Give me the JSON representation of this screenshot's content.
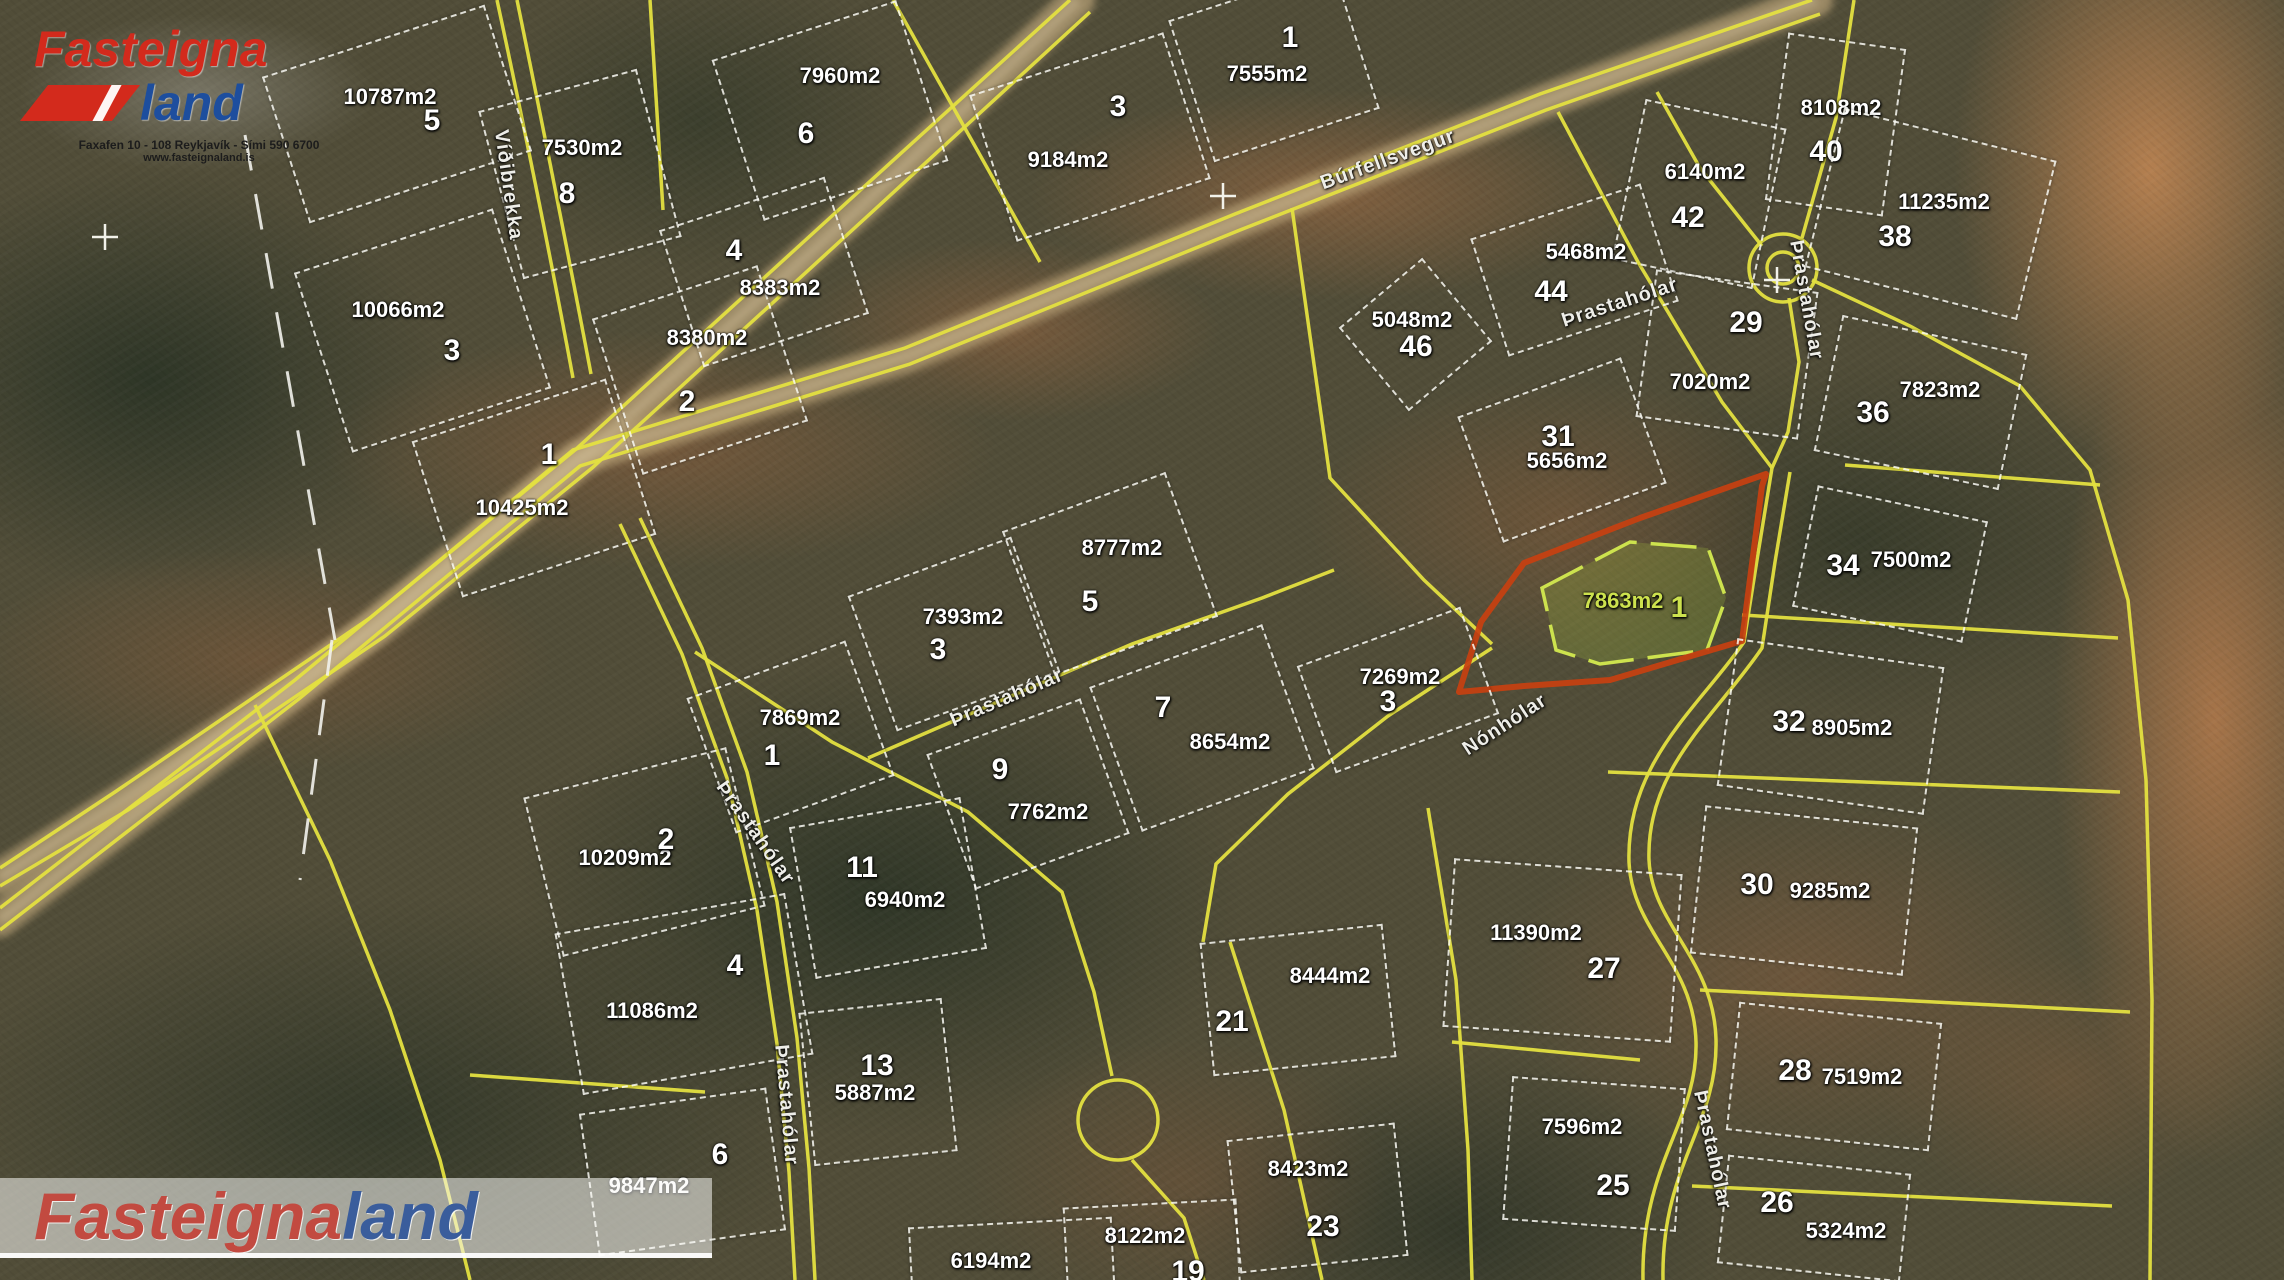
{
  "watermark_top": {
    "brand_red": "Fasteigna",
    "brand_blue": "land",
    "address_line": "Faxafen 10 - 108 Reykjavík - Sími 590 6700",
    "website": "www.fasteignaland.is"
  },
  "watermark_bottom": {
    "brand_red": "Fasteigna",
    "brand_blue": "land"
  },
  "colors": {
    "boundary_yellow": "#e4e040",
    "parcel_white": "#f2f2ec",
    "highlight_red": "#c84010",
    "highlight_green": "#cde24e",
    "gravel": "#b7a076",
    "label_white": "#ffffff"
  },
  "highlighted_lot": {
    "number": "1",
    "area": "7863m2"
  },
  "parcels": [
    {
      "num": "5",
      "nx": 432,
      "ny": 121,
      "area": "10787m2",
      "ax": 390,
      "ay": 97,
      "box": [
        395,
        112,
        230,
        150,
        -18
      ]
    },
    {
      "num": "8",
      "nx": 567,
      "ny": 194,
      "area": "7530m2",
      "ax": 582,
      "ay": 148,
      "box": [
        578,
        172,
        160,
        170,
        -15
      ]
    },
    {
      "num": "6",
      "nx": 806,
      "ny": 134,
      "area": "7960m2",
      "ax": 840,
      "ay": 76,
      "box": [
        828,
        108,
        190,
        165,
        -18
      ]
    },
    {
      "num": "3",
      "nx": 1118,
      "ny": 107,
      "area": "9184m2",
      "ax": 1068,
      "ay": 160,
      "box": [
        1088,
        135,
        200,
        150,
        -18
      ]
    },
    {
      "num": "1",
      "nx": 1290,
      "ny": 38,
      "area": "7555m2",
      "ax": 1267,
      "ay": 74,
      "box": [
        1272,
        62,
        170,
        145,
        -18
      ]
    },
    {
      "num": "40",
      "nx": 1826,
      "ny": 152,
      "area": "8108m2",
      "ax": 1841,
      "ay": 108,
      "box": [
        1833,
        122,
        115,
        165,
        8
      ]
    },
    {
      "num": "42",
      "nx": 1688,
      "ny": 218,
      "area": "6140m2",
      "ax": 1705,
      "ay": 172,
      "box": [
        1697,
        192,
        140,
        160,
        12
      ]
    },
    {
      "num": "44",
      "nx": 1551,
      "ny": 292,
      "area": "5468m2",
      "ax": 1586,
      "ay": 252,
      "box": [
        1572,
        268,
        175,
        120,
        -18
      ]
    },
    {
      "num": "46",
      "nx": 1416,
      "ny": 347,
      "area": "5048m2",
      "ax": 1412,
      "ay": 320,
      "box": [
        1413,
        332,
        105,
        105,
        -40
      ]
    },
    {
      "num": "38",
      "nx": 1895,
      "ny": 237,
      "area": "11235m2",
      "ax": 1944,
      "ay": 202,
      "box": [
        1928,
        212,
        215,
        160,
        14
      ]
    },
    {
      "num": "29",
      "nx": 1746,
      "ny": 323,
      "area": "7020m2",
      "ax": 1710,
      "ay": 382,
      "box": [
        1725,
        352,
        160,
        145,
        8
      ]
    },
    {
      "num": "36",
      "nx": 1873,
      "ny": 413,
      "area": "7823m2",
      "ax": 1940,
      "ay": 390,
      "box": [
        1918,
        400,
        185,
        135,
        12
      ]
    },
    {
      "num": "31",
      "nx": 1558,
      "ny": 437,
      "area": "5656m2",
      "ax": 1567,
      "ay": 461,
      "box": [
        1560,
        448,
        170,
        130,
        -20
      ]
    },
    {
      "num": "34",
      "nx": 1843,
      "ny": 566,
      "area": "7500m2",
      "ax": 1911,
      "ay": 560,
      "box": [
        1888,
        562,
        170,
        120,
        12
      ]
    },
    {
      "num": "32",
      "nx": 1789,
      "ny": 722,
      "area": "8905m2",
      "ax": 1852,
      "ay": 728,
      "box": [
        1828,
        724,
        205,
        145,
        8
      ]
    },
    {
      "num": "30",
      "nx": 1757,
      "ny": 885,
      "area": "9285m2",
      "ax": 1830,
      "ay": 891,
      "box": [
        1802,
        888,
        210,
        145,
        6
      ]
    },
    {
      "num": "27",
      "nx": 1604,
      "ny": 969,
      "area": "11390m2",
      "ax": 1536,
      "ay": 933,
      "box": [
        1560,
        948,
        225,
        165,
        4
      ]
    },
    {
      "num": "28",
      "nx": 1795,
      "ny": 1071,
      "area": "7519m2",
      "ax": 1862,
      "ay": 1077,
      "box": [
        1832,
        1074,
        200,
        125,
        6
      ]
    },
    {
      "num": "25",
      "nx": 1613,
      "ny": 1186,
      "area": "7596m2",
      "ax": 1582,
      "ay": 1127,
      "box": [
        1592,
        1152,
        170,
        140,
        4
      ]
    },
    {
      "num": "26",
      "nx": 1777,
      "ny": 1203,
      "area": "5324m2",
      "ax": 1846,
      "ay": 1231,
      "box": [
        1812,
        1216,
        180,
        105,
        6
      ]
    },
    {
      "num": "3",
      "nx": 452,
      "ny": 351,
      "area": "10066m2",
      "ax": 398,
      "ay": 310,
      "box": [
        420,
        328,
        205,
        185,
        -18
      ]
    },
    {
      "num": "2",
      "nx": 687,
      "ny": 402,
      "area": "8380m2",
      "ax": 707,
      "ay": 338,
      "box": [
        698,
        368,
        170,
        160,
        -18
      ]
    },
    {
      "num": "4",
      "nx": 734,
      "ny": 251,
      "area": "8383m2",
      "ax": 780,
      "ay": 288,
      "box": [
        762,
        270,
        170,
        140,
        -18
      ]
    },
    {
      "num": "1",
      "nx": 549,
      "ny": 455,
      "area": "10425m2",
      "ax": 522,
      "ay": 508,
      "box": [
        532,
        486,
        200,
        160,
        -18
      ]
    },
    {
      "num": "3",
      "nx": 938,
      "ny": 650,
      "area": "7393m2",
      "ax": 963,
      "ay": 617,
      "box": [
        952,
        632,
        170,
        140,
        -20
      ]
    },
    {
      "num": "5",
      "nx": 1090,
      "ny": 602,
      "area": "8777m2",
      "ax": 1122,
      "ay": 548,
      "box": [
        1108,
        572,
        170,
        150,
        -20
      ]
    },
    {
      "num": "1",
      "nx": 772,
      "ny": 756,
      "area": "7869m2",
      "ax": 800,
      "ay": 718,
      "box": [
        788,
        735,
        165,
        140,
        -20
      ]
    },
    {
      "num": "7",
      "nx": 1163,
      "ny": 708,
      "area": "8654m2",
      "ax": 1230,
      "ay": 742,
      "box": [
        1200,
        726,
        180,
        150,
        -20
      ]
    },
    {
      "num": "3",
      "nx": 1388,
      "ny": 702,
      "area": "7269m2",
      "ax": 1400,
      "ay": 677,
      "box": [
        1396,
        688,
        170,
        110,
        -20
      ]
    },
    {
      "num": "9",
      "nx": 1000,
      "ny": 770,
      "area": "7762m2",
      "ax": 1048,
      "ay": 812,
      "box": [
        1026,
        792,
        160,
        140,
        -20
      ]
    },
    {
      "num": "2",
      "nx": 666,
      "ny": 840,
      "area": "10209m2",
      "ax": 625,
      "ay": 858,
      "box": [
        642,
        850,
        205,
        160,
        -14
      ]
    },
    {
      "num": "11",
      "nx": 862,
      "ny": 868,
      "area": "6940m2",
      "ax": 905,
      "ay": 900,
      "box": [
        886,
        886,
        170,
        150,
        -10
      ]
    },
    {
      "num": "4",
      "nx": 735,
      "ny": 966,
      "area": "11086m2",
      "ax": 652,
      "ay": 1011,
      "box": [
        682,
        992,
        230,
        160,
        -10
      ]
    },
    {
      "num": "6",
      "nx": 720,
      "ny": 1155,
      "area": "9847m2",
      "ax": 649,
      "ay": 1186,
      "box": [
        680,
        1170,
        185,
        140,
        -8
      ]
    },
    {
      "num": "13",
      "nx": 877,
      "ny": 1066,
      "area": "5887m2",
      "ax": 875,
      "ay": 1093,
      "box": [
        876,
        1080,
        140,
        150,
        -6
      ]
    },
    {
      "num": "19",
      "nx": 1188,
      "ny": 1272,
      "area": "6194m2",
      "ax": 991,
      "ay": 1261,
      "box": [
        1010,
        1262,
        200,
        80,
        -3
      ]
    },
    {
      "area": "8122m2",
      "ax": 1145,
      "ay": 1236,
      "box": [
        1150,
        1248,
        170,
        90,
        -3
      ]
    },
    {
      "num": "23",
      "nx": 1323,
      "ny": 1227,
      "area": "8423m2",
      "ax": 1308,
      "ay": 1169,
      "box": [
        1315,
        1196,
        165,
        130,
        -6
      ]
    },
    {
      "num": "21",
      "nx": 1232,
      "ny": 1022,
      "area": "8444m2",
      "ax": 1330,
      "ay": 976,
      "box": [
        1296,
        998,
        180,
        130,
        -6
      ]
    },
    {
      "num": "1",
      "nx": 1679,
      "ny": 608,
      "area": "7863m2",
      "ax": 1623,
      "ay": 601,
      "hl": true
    }
  ],
  "road_labels": [
    {
      "name": "Víðibrekka",
      "x": 508,
      "y": 185,
      "rot": 82
    },
    {
      "name": "Búrfellsvegur",
      "x": 1388,
      "y": 160,
      "rot": -20
    },
    {
      "name": "Þrastahólar",
      "x": 1620,
      "y": 303,
      "rot": -18
    },
    {
      "name": "Þrastahólar",
      "x": 1806,
      "y": 300,
      "rot": 80
    },
    {
      "name": "Þrastahólar",
      "x": 1007,
      "y": 698,
      "rot": -23
    },
    {
      "name": "Þrastahólar",
      "x": 755,
      "y": 833,
      "rot": 55
    },
    {
      "name": "Þrastahólar",
      "x": 786,
      "y": 1105,
      "rot": 85
    },
    {
      "name": "Þrastahólar",
      "x": 1712,
      "y": 1150,
      "rot": 78
    },
    {
      "name": "Nónhólar",
      "x": 1505,
      "y": 725,
      "rot": -33
    }
  ],
  "crosshair_markers": [
    {
      "x": 105,
      "y": 237
    },
    {
      "x": 1223,
      "y": 196
    },
    {
      "x": 1777,
      "y": 280
    }
  ]
}
